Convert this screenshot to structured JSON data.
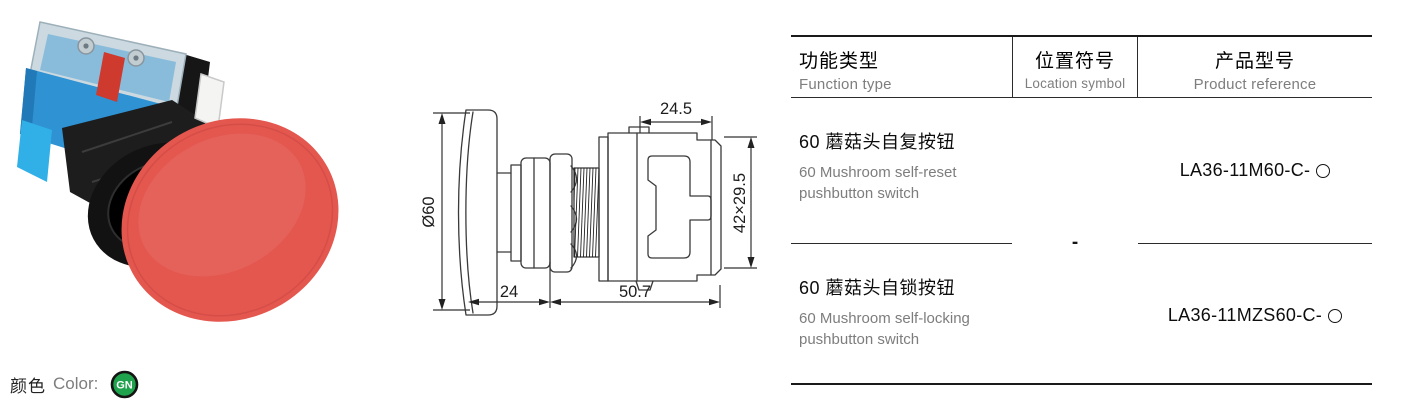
{
  "product_photo": {
    "description": "60mm red mushroom-head pushbutton switch, angled product photo",
    "cap_color": "#e4574f",
    "contact_block_blue": "#2e92d3",
    "clip_blue": "#30b0e6",
    "housing_black": "#1d1d1d",
    "plunger_red": "#cf3a2e",
    "cover_gray": "#ccd9e0"
  },
  "drawing": {
    "dim_cap_diameter": "Ø60",
    "dim_cap_depth": "24",
    "dim_body_length": "50.7",
    "dim_block_width": "24.5",
    "dim_block_hw": "42×29.5"
  },
  "table": {
    "header": {
      "function": {
        "zh": "功能类型",
        "en": "Function type"
      },
      "location": {
        "zh": "位置符号",
        "en": "Location symbol"
      },
      "product": {
        "zh": "产品型号",
        "en": "Product reference"
      }
    },
    "rows": [
      {
        "zh": "60 蘑菇头自复按钮",
        "en1": "60 Mushroom self-reset",
        "en2": "pushbutton switch",
        "ref": "LA36-11M60-C-"
      },
      {
        "zh": "60 蘑菇头自锁按钮",
        "en1": "60 Mushroom self-locking",
        "en2": "pushbutton switch",
        "ref": "LA36-11MZS60-C-"
      }
    ],
    "location_value": "-",
    "product_placeholder_icon": "circle-outline"
  },
  "legend": {
    "zh": "颜色",
    "en": "Color:",
    "badge": "GN",
    "badge_color": "#1fa24c"
  }
}
